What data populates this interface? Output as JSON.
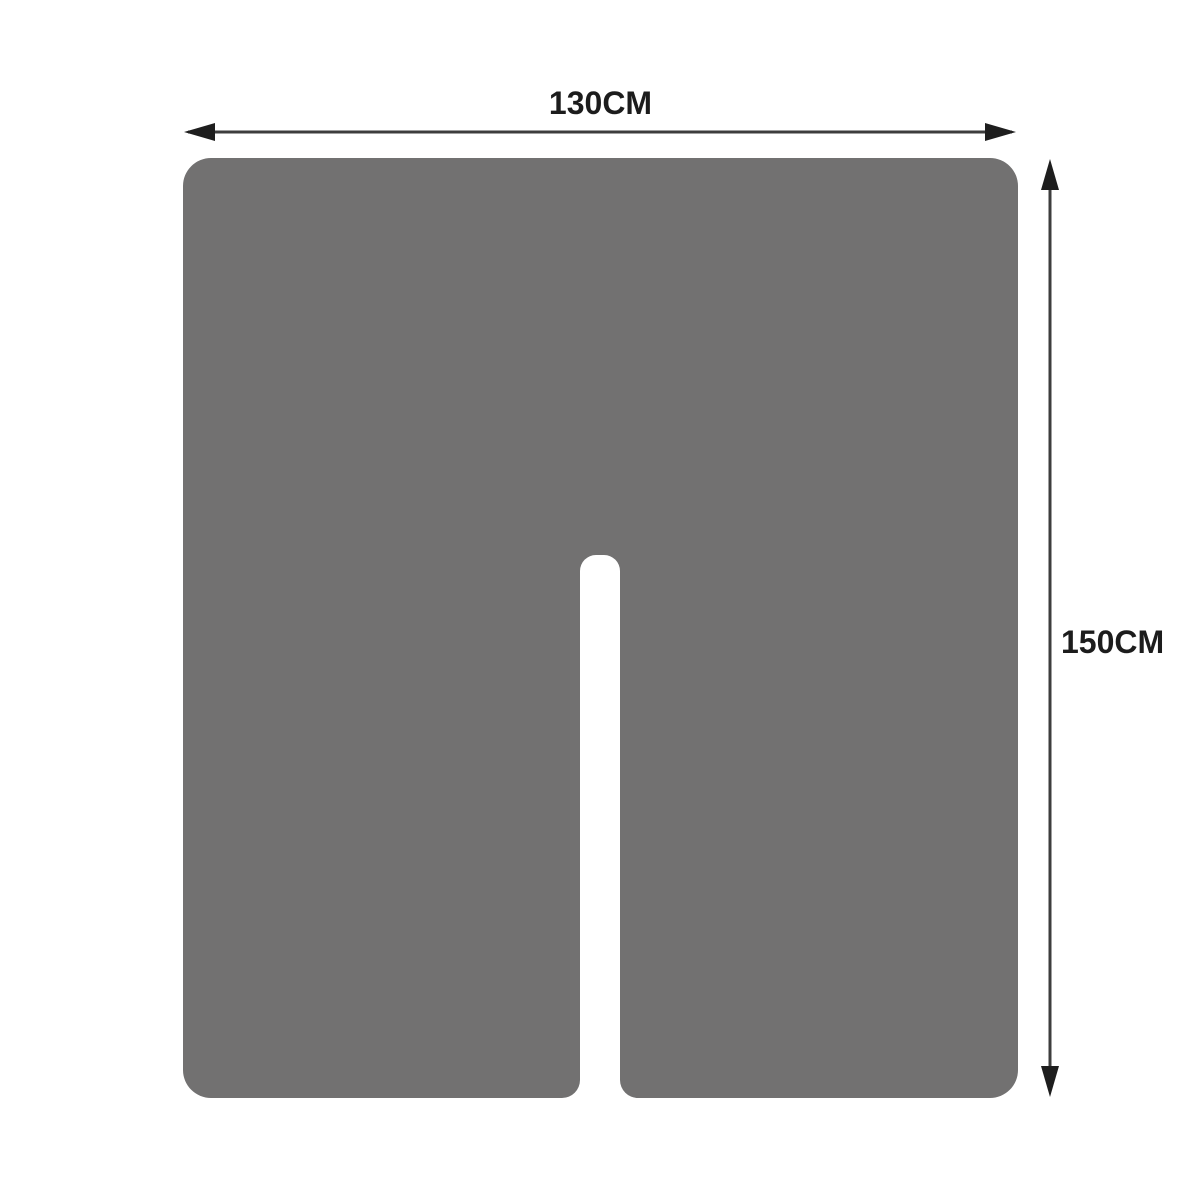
{
  "diagram": {
    "description": "product-dimension-diagram",
    "width_dimension": {
      "label": "130CM"
    },
    "height_dimension": {
      "label": "150CM"
    }
  },
  "colors": {
    "background": "#ffffff",
    "shape_fill": "#727171",
    "arrow_line": "#3d3d3d",
    "arrow_head": "#1e1e1e",
    "label_text": "#1c1c1c"
  }
}
